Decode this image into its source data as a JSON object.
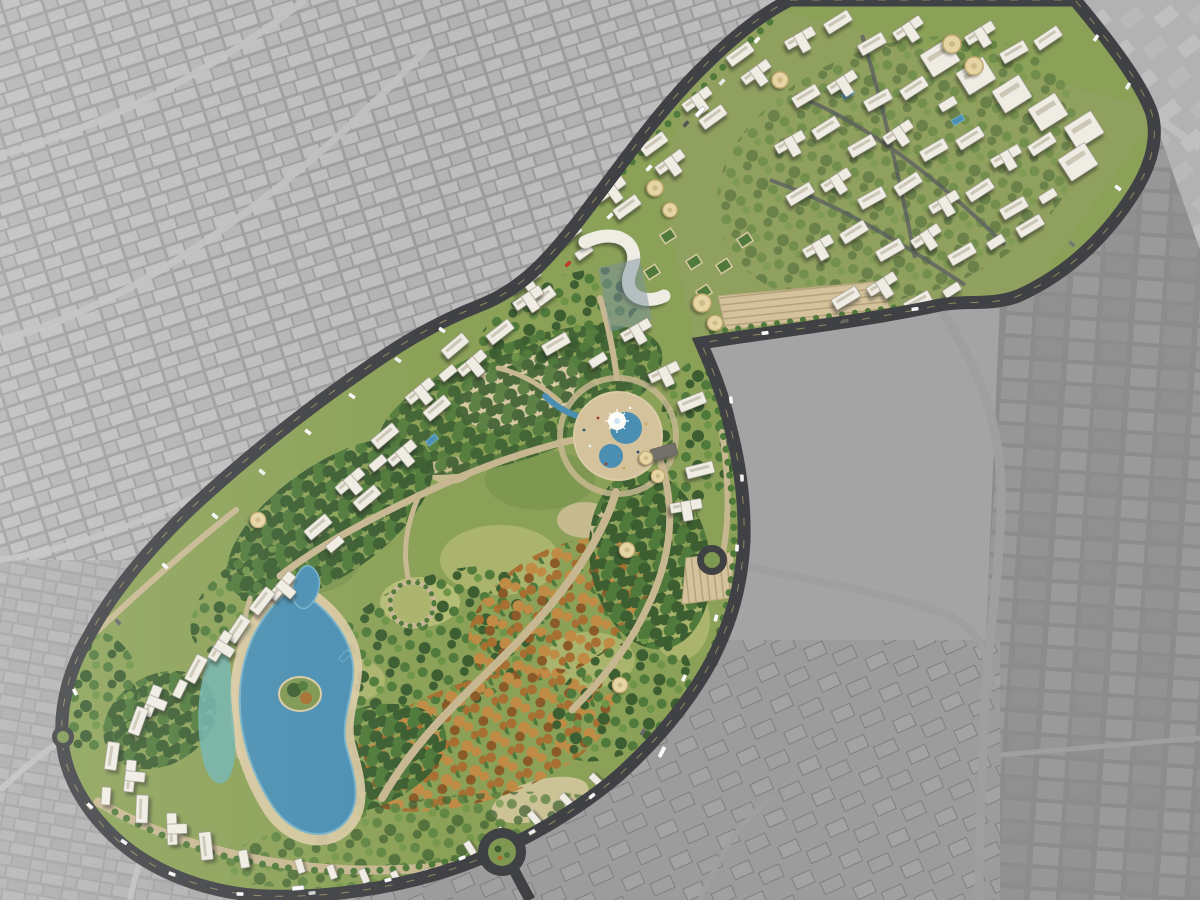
{
  "meta": {
    "image_type": "aerial-masterplan-rendering",
    "description": "Bird's-eye architectural rendering of a crescent-shaped residential master plan with a large central park, lagoon and fountain plaza, composited over a desaturated gray aerial photograph of surrounding desert-city blocks",
    "visible_text": "none"
  },
  "palette": {
    "gray_base": "#a4a4a4",
    "gray_streets": "#9c9c9c",
    "gray_block_light": "#bcbcbc",
    "gray_block_mid": "#b0b0b0",
    "gray_zone_dark": "#8c8c8c",
    "gray_road_light": "#c0c0c0",
    "road_dark": "#3f4144",
    "road_median": "#b3a76c",
    "dev_green": "#8ba157",
    "lawn_light": "#aab46c",
    "lawn_mid": "#7e9751",
    "tree_dark": "#3c5e31",
    "tree_mid": "#507a3b",
    "tree_light": "#6d9447",
    "autumn": "#a76f31",
    "autumn_light": "#c08b44",
    "autumn_deep": "#8a5a28",
    "path_tan": "#c7b791",
    "plaza_tan": "#d3c29c",
    "sand_tan": "#dbcba6",
    "parking_line": "#b2a078",
    "water_deep": "#4a8fb2",
    "water_light": "#77b1c8",
    "water_teal": "#6fb3ad",
    "bldg_white": "#efece3",
    "bldg_inner": "#ccc6b6",
    "bldg_edge": "#8d897c",
    "bldg_dark": "#74706a",
    "dome": "#e5d5a4",
    "dome_rim": "#c0a86e",
    "fountain_white": "#fbfbf6",
    "car_white": "#f7f7f7"
  },
  "regions": [
    {
      "name": "surrounding-city",
      "description": "desaturated gray aerial photo of dense low-rise city blocks surrounding the site"
    },
    {
      "name": "development-site",
      "description": "full-color crescent / boomerang shaped master-planned community"
    },
    {
      "name": "north-residential-district",
      "description": "dense grid of white mid-rise apartment towers with landscaped courtyards and green-roof courts"
    },
    {
      "name": "northeast-slab-row",
      "description": "row of large white slab buildings along the northeast edge of the north district"
    },
    {
      "name": "central-park",
      "description": "large landscaped park with lawns, dense green and autumn tree clusters and winding tan paths"
    },
    {
      "name": "fountain-plaza",
      "description": "circular tan plaza with curved blue water feature and white central fountain"
    },
    {
      "name": "lagoon",
      "description": "winding blue lagoon with a planted island and teal shallow pool in the southwest of the park"
    },
    {
      "name": "perimeter-ring-road",
      "description": "dark asphalt boulevard with traffic encircling the development"
    },
    {
      "name": "edge-residential-towers",
      "description": "white residential towers lining the northwest and southwest edges"
    },
    {
      "name": "domed-pavilions",
      "description": "beige parachute-roof pavilions scattered along promenades and entries"
    },
    {
      "name": "roundabouts",
      "description": "landscaped traffic circles on the ring road"
    },
    {
      "name": "construction-blocks",
      "description": "darker gray plots and unfinished block outlines east and south of the site"
    }
  ]
}
